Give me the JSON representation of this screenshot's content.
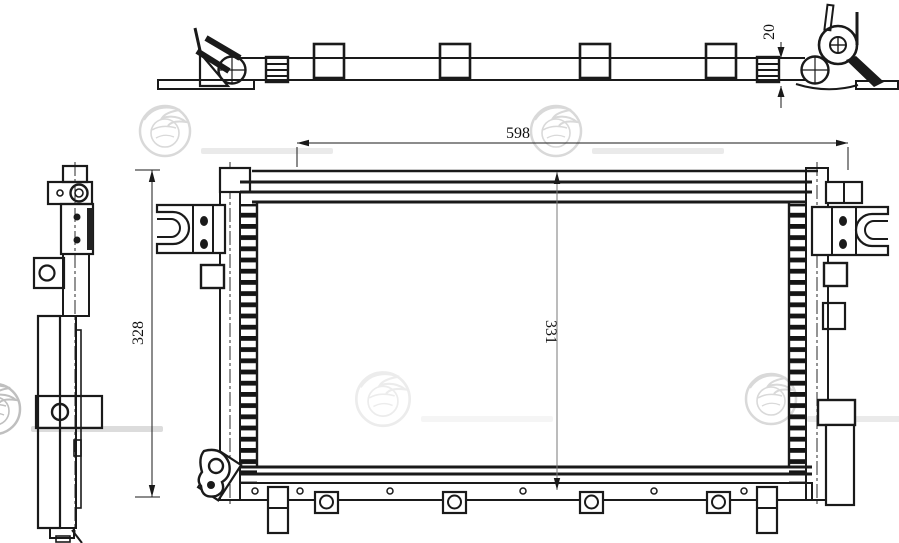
{
  "watermarks": {
    "brand": "LUZAR"
  },
  "dimensions": {
    "overall_width": "598",
    "side_height": "328",
    "core_height": "331",
    "pipe_offset": "20"
  },
  "colors": {
    "line": "#1a1a1a",
    "dimension_line": "#7a7a7a",
    "watermark": "#d9d9d9",
    "background": "#ffffff"
  }
}
